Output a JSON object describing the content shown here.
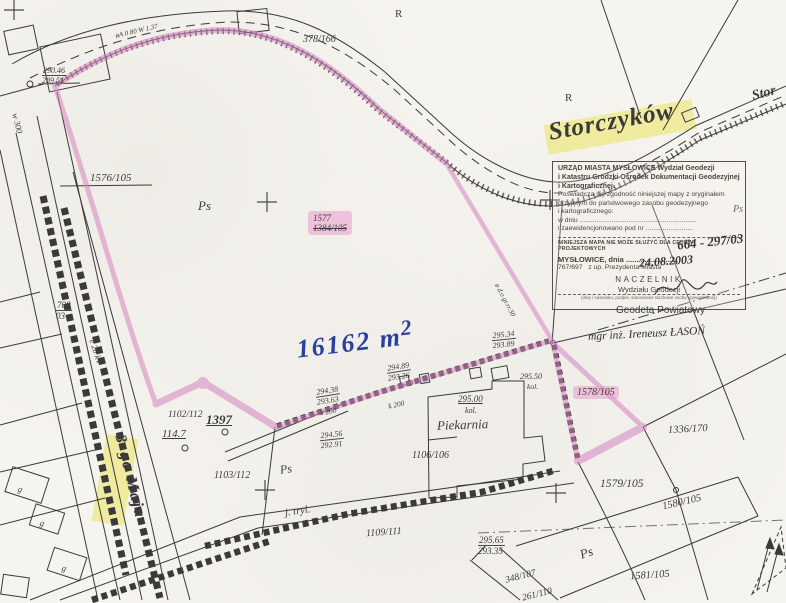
{
  "colors": {
    "paper": "#f6f4ef",
    "line": "#3a3a3a",
    "highlight_pink": "#d584bf",
    "highlight_yellow": "#ece35f",
    "ink_blue": "#2b3f9e"
  },
  "street_names": {
    "storczykow": "Storczyków",
    "storczykow_cont": "Stor",
    "trzeciego_maja": "3-go Maja"
  },
  "area_label": {
    "text": "16162 m",
    "exponent": "2"
  },
  "parcels": {
    "p1576_105": "1576/105",
    "p378_166": "378/166",
    "p1577": "1577",
    "p1384_105": "1384/105",
    "p708_num": "708",
    "p708_den": "03",
    "p1102_112": "1102/112",
    "p1397": "1397",
    "p114_7": "114.7",
    "p1103_112": "1103/112",
    "p1106_106": "1106/106",
    "p1109_111": "1109/111",
    "p1336_170": "1336/170",
    "p1578_105": "1578/105",
    "p1579_105": "1579/105",
    "p1580_105": "1580/105",
    "p1581_105": "1581/105",
    "p348_107": "348/107",
    "p261_110": "261/110"
  },
  "elevations": {
    "e1_top": "290.46",
    "e1_bot": "289.51",
    "e2_top": "294.38",
    "e2_bot": "293.63",
    "e3_top": "294.56",
    "e3_bot": "292.91",
    "e4_top": "294.89",
    "e4_bot": "293.26",
    "e5_top": "295.34",
    "e5_bot": "293.89",
    "e6": "295.50",
    "e7": "295.00",
    "e8_top": "295.65",
    "e8_bot": "293.35"
  },
  "land_use": {
    "ps_a": "Ps",
    "ps_b": "Ps",
    "ps_c": "Ps",
    "ps_d": "Ps",
    "r_a": "R",
    "r_b": "R",
    "j_tryl": "j. tryl."
  },
  "buildings": {
    "piekarnia": "Piekarnia",
    "g_a": "g",
    "g_b": "g",
    "g_c": "g"
  },
  "utilities": {
    "k200_a": "k 200",
    "k200_b": "k 200",
    "e20kv": "e 20 kV",
    "w300": "w 300",
    "gas": "øA 0 80 W 1.37",
    "pipe": "ø d.o gr.rr.30",
    "kol_a": "kol.",
    "kol_b": "kol."
  },
  "stamp": {
    "line1": "URZĄD MIASTA MYSŁOWICE Wydział Geodezji",
    "line2": "i Katastru Grodzki Ośrodek Dokumentacji Geodezyjnej",
    "line3": "i Kartograficznej.",
    "line4": "Poświadcza się zgodność niniejszej mapy z oryginałem",
    "line5": "przyjętym do państwowego zasobu geodezyjnego",
    "line6": "i kartograficznego:",
    "line7": "w dniu ..............................................................",
    "line8": "i zaewidencjonowano pod nr .........................",
    "reg_number": "664 - 297/03",
    "warning": "NINIEJSZA MAPA NIE MOŻE SŁUŻYĆ DLA CELÓW PROJEKTOWYCH",
    "city_line": "MYSŁOWICE, dnia .........................",
    "date_hand": "24.08.2003",
    "ref_number": "767/697",
    "on_behalf": "z up. Prezydenta Miasta",
    "naczelnik": "NACZELNIK",
    "dept": "Wydziału Geodezji",
    "small_note": "(imię i nazwisko, podpis, stanowisko służbowe osoby upoważnionej)"
  },
  "surveyor": {
    "title": "Geodeta Powiatowy",
    "name": "mgr inż. Ireneusz ŁASOŃ"
  }
}
